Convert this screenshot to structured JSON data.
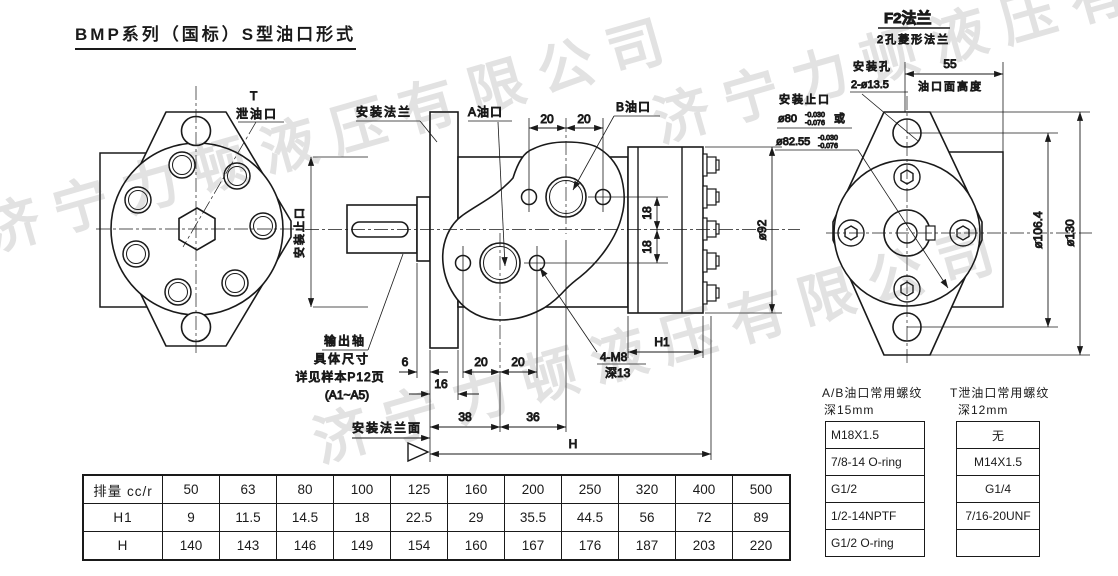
{
  "title": "BMP系列（国标）S型油口形式",
  "watermark": "济宁力顿液压有限公司",
  "left_view": {
    "t_port_line1": "T",
    "t_port_line2": "泄油口"
  },
  "middle_view": {
    "labels": {
      "mount_flange": "安装法兰",
      "a_port": "A油口",
      "b_port": "B油口",
      "spigot": "安装止口",
      "output_shaft_1": "输出轴",
      "output_shaft_2": "具体尺寸",
      "output_shaft_3": "详见样本P12页",
      "output_shaft_4": "(A1~A5)",
      "flange_face": "安装法兰面",
      "bolt_holes_1": "4-M8",
      "bolt_holes_2": "深13"
    },
    "dims": {
      "d20": "20",
      "d18": "18",
      "d6": "6",
      "d16": "16",
      "d38": "38",
      "d36": "36",
      "dH": "H",
      "dH1": "H1",
      "d92": "ø92"
    }
  },
  "f2_view": {
    "header_line1": "F2法兰",
    "header_line2": "2孔菱形法兰",
    "labels": {
      "mount_holes_1": "安装孔",
      "mount_holes_2": "2-ø13.5",
      "spigot": "安装止口",
      "spigot_d1": "ø80",
      "spigot_d1_tol_upper": "-0.030",
      "spigot_d1_tol_lower": "-0.076",
      "spigot_d1_suffix": "或",
      "spigot_d2": "ø82.55",
      "spigot_d2_tol_upper": "-0.030",
      "spigot_d2_tol_lower": "-0.076",
      "port_face_height": "油口面高度"
    },
    "dims": {
      "d55": "55",
      "d106": "ø106.4",
      "d130": "ø130"
    }
  },
  "main_table": {
    "rows": [
      {
        "label": "排量 cc/r",
        "values": [
          "50",
          "63",
          "80",
          "100",
          "125",
          "160",
          "200",
          "250",
          "320",
          "400",
          "500"
        ]
      },
      {
        "label": "H1",
        "values": [
          "9",
          "11.5",
          "14.5",
          "18",
          "22.5",
          "29",
          "35.5",
          "44.5",
          "56",
          "72",
          "89"
        ]
      },
      {
        "label": "H",
        "values": [
          "140",
          "143",
          "146",
          "149",
          "154",
          "160",
          "167",
          "176",
          "187",
          "203",
          "220"
        ]
      }
    ]
  },
  "ab_port_table": {
    "caption1": "A/B油口常用螺纹",
    "caption2": "深15mm",
    "rows": [
      "M18X1.5",
      "7/8-14 O-ring",
      "G1/2",
      "1/2-14NPTF",
      "G1/2 O-ring"
    ]
  },
  "t_port_table": {
    "caption1": "T泄油口常用螺纹",
    "caption2": "深12mm",
    "rows": [
      "无",
      "M14X1.5",
      "G1/4",
      "7/16-20UNF",
      ""
    ]
  }
}
